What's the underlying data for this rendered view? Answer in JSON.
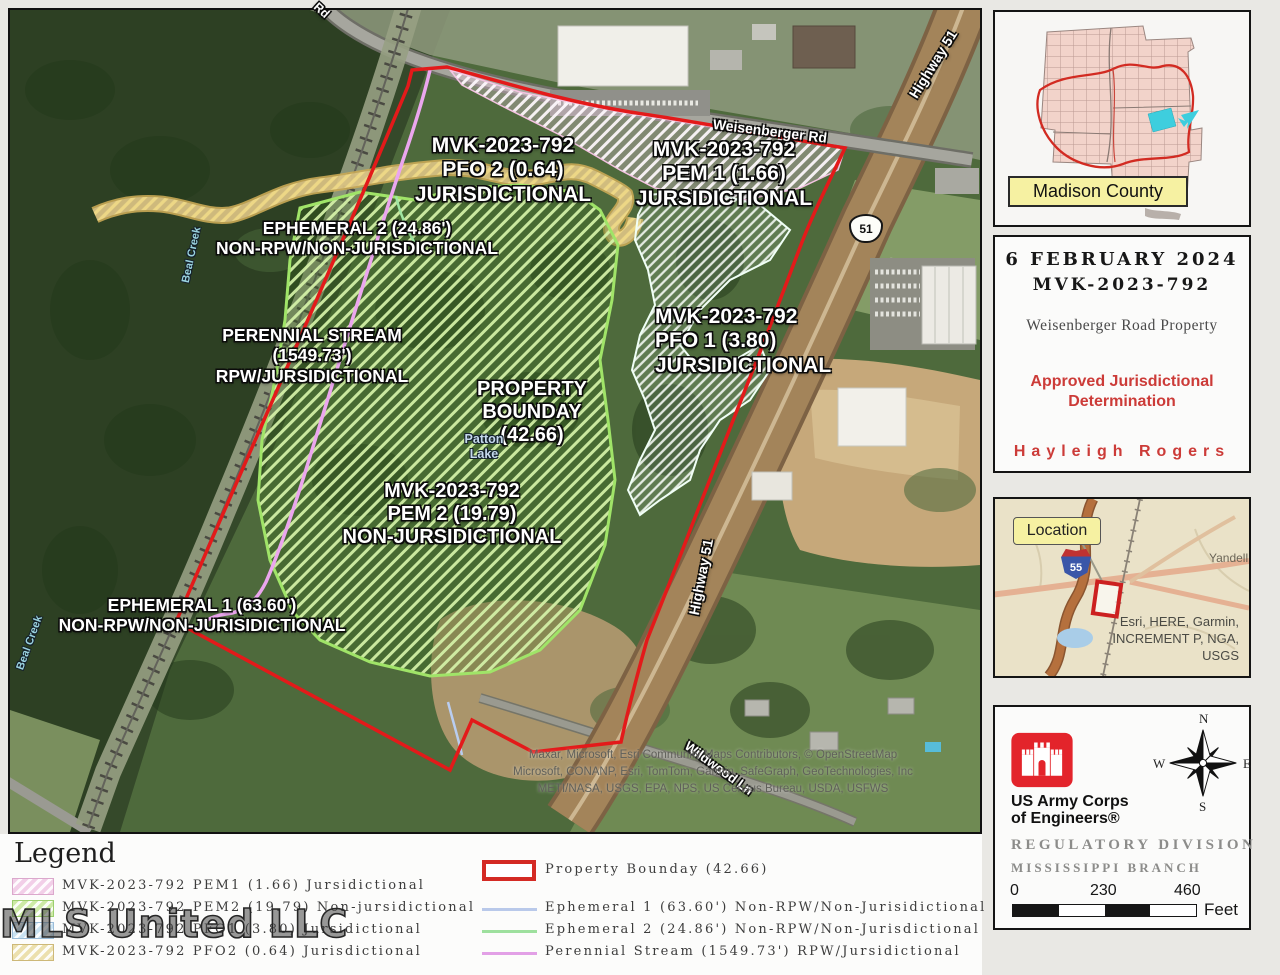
{
  "map": {
    "labels": {
      "pfo2": {
        "l1": "MVK-2023-792",
        "l2": "PFO 2 (0.64)",
        "l3": "JURISDICTIONAL"
      },
      "pem1": {
        "l1": "MVK-2023-792",
        "l2": "PEM 1 (1.66)",
        "l3": "JURSIDICTIONAL"
      },
      "eph2": {
        "l1": "EPHEMERAL 2 (24.86')",
        "l2": "NON-RPW/NON-JURISDICTIONAL"
      },
      "perennial": {
        "l1": "PERENNIAL STREAM",
        "l2": "(1549.73')",
        "l3": "RPW/JURSIDICTIONAL"
      },
      "boundary": {
        "l1": "PROPERTY",
        "l2": "BOUNDAY",
        "l3": "(42.66)"
      },
      "pfo1": {
        "l1": "MVK-2023-792",
        "l2": "PFO 1 (3.80)",
        "l3": "JURSIDICTIONAL"
      },
      "pem2": {
        "l1": "MVK-2023-792",
        "l2": "PEM 2 (19.79)",
        "l3": "NON-JURSIDICTIONAL"
      },
      "eph1": {
        "l1": "EPHEMERAL 1 (63.60')",
        "l2": "NON-RPW/NON-JURISIDICTIONAL"
      }
    },
    "roads": {
      "weisenberger": "Weisenberger Rd",
      "highway51": "Highway 51",
      "wildwood": "Wildwood Ln",
      "partial": "Rd",
      "shield51": "51"
    },
    "water": {
      "patton_l1": "Patton",
      "patton_l2": "Lake",
      "beal": "Beal Creek"
    },
    "attribution": [
      "Maxar, Microsoft, Esri Community Maps Contributors, © OpenStreetMap",
      "Microsoft, CONANP, Esri, TomTom, Garmin, SafeGraph, GeoTechnologies, Inc",
      "METI/NASA, USGS, EPA, NPS, US Census Bureau, USDA, USFWS"
    ]
  },
  "county_inset": {
    "label": "Madison County"
  },
  "title_panel": {
    "date": "6 FEBRUARY 2024",
    "project_number": "MVK-2023-792",
    "property_name": "Weisenberger Road Property",
    "status_l1": "Approved Jurisdictional",
    "status_l2": "Determination",
    "author": "Hayleigh Rogers"
  },
  "location_inset": {
    "callout": "Location",
    "shield": "55",
    "road": "Yandell",
    "attribution_l1": "Esri, HERE, Garmin,",
    "attribution_l2": "INCREMENT P, NGA,",
    "attribution_l3": "USGS"
  },
  "branding_panel": {
    "org_l1": "US Army Corps",
    "org_l2": "of Engineers®",
    "division": "REGULATORY DIVISION",
    "branch": "MISSISSIPPI BRANCH",
    "compass": {
      "n": "N",
      "e": "E",
      "s": "S",
      "w": "W"
    },
    "scale": {
      "t0": "0",
      "t1": "230",
      "t2": "460",
      "unit": "Feet"
    }
  },
  "legend": {
    "heading": "Legend",
    "areas": [
      {
        "label": "MVK-2023-792 PEM1 (1.66) Jursidictional",
        "color": "#f2cfe8"
      },
      {
        "label": "MVK-2023-792 PEM2 (19.79) Non-jursidictional",
        "color": "#cdeaa6"
      },
      {
        "label": "MVK-2023-792 PFO1 (3.80) Jursidictional",
        "color": "#c9e2f2"
      },
      {
        "label": "MVK-2023-792 PFO2 (0.64) Jurisdictional",
        "color": "#ece0ae"
      }
    ],
    "boundary_label": "Property Bounday (42.66)",
    "lines": [
      {
        "label": "Ephemeral 1 (63.60') Non-RPW/Non-Jurisidictional",
        "color": "#b9c9ea"
      },
      {
        "label": "Ephemeral 2 (24.86') Non-RPW/Non-Jurisdictional",
        "color": "#9ee09e"
      },
      {
        "label": "Perennial Stream (1549.73') RPW/Jursidictional",
        "color": "#e2a0e6"
      }
    ]
  },
  "watermark": "MLS United LLC",
  "colors": {
    "boundary_red": "#e31a1a",
    "stream_pink": "#eba6ee",
    "status_red": "#cc3b38"
  }
}
